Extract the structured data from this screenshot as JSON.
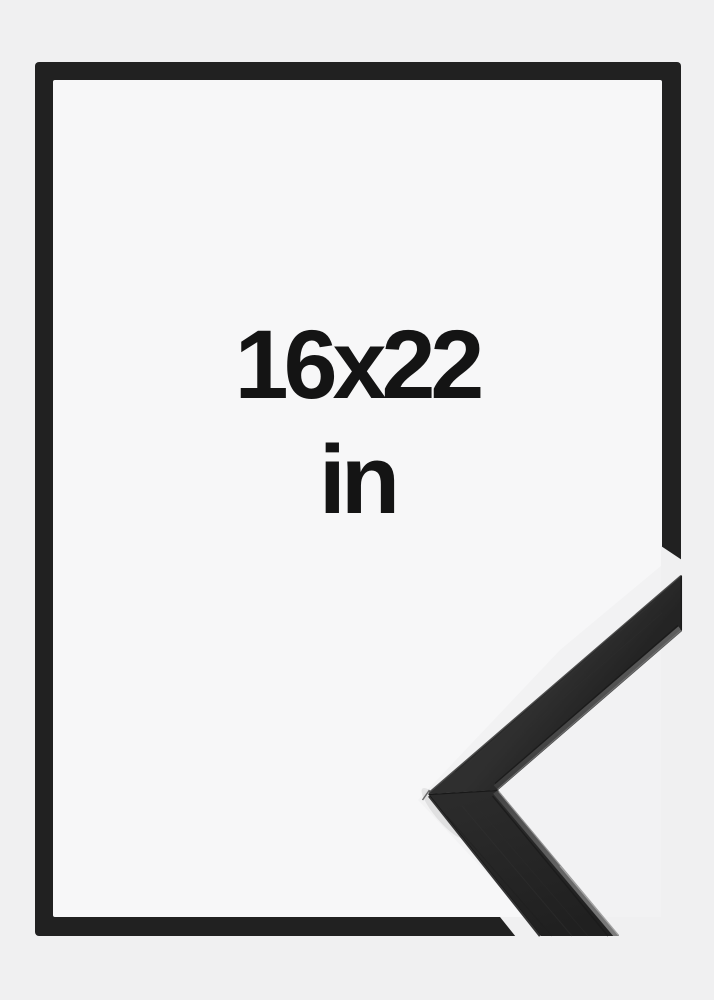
{
  "product_image": {
    "description": "Black picture frame size mock-up with corner profile sample",
    "size_label": "16x22",
    "unit_label": "in"
  },
  "colors": {
    "bg": "#f0f0f1",
    "bg-inner": "#f7f7f8",
    "bg-photo": "#f2f2f3",
    "frame": "#212121",
    "text": "#141414"
  }
}
